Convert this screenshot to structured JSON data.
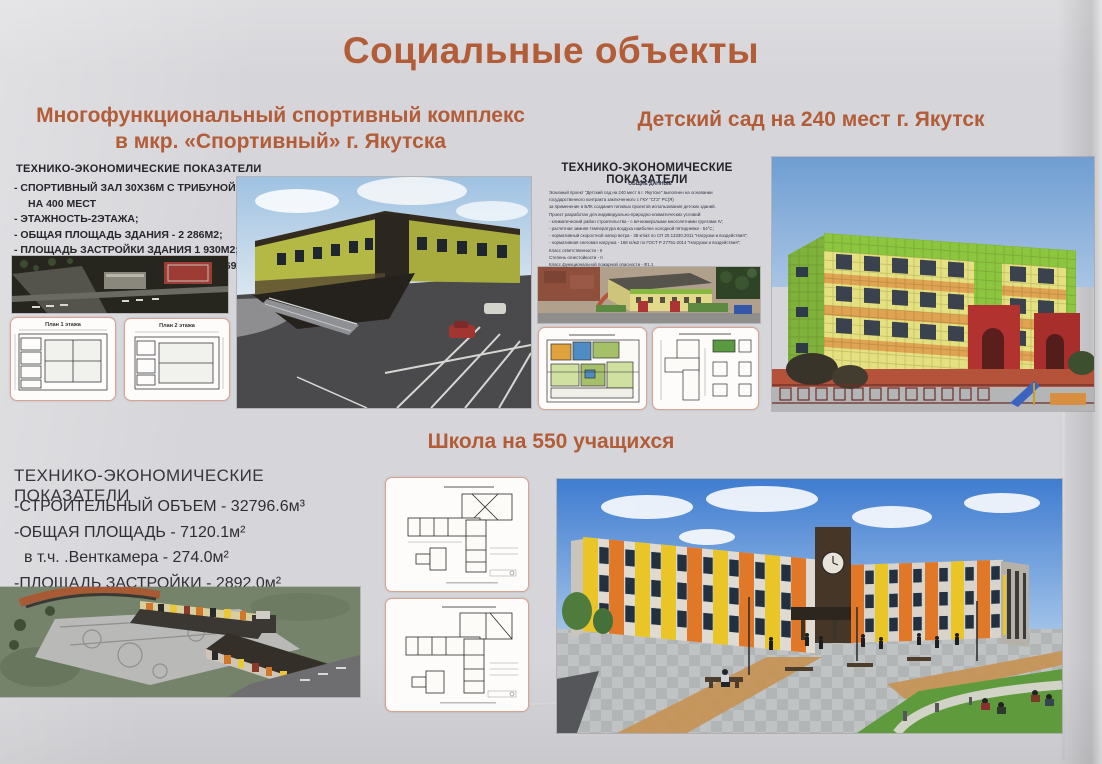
{
  "title": "Социальные объекты",
  "colors": {
    "accent": "#b25c38",
    "poster_bg": "#d6d6da",
    "body_text": "#26262b",
    "tep_text": "#35353b"
  },
  "sport": {
    "title_line1": "Многофункциональный спортивный комплекс",
    "title_line2": "в мкр. «Спортивный» г. Якутска",
    "tep_heading": "ТЕХНИКО-ЭКОНОМИЧЕСКИЕ ПОКАЗАТЕЛИ",
    "indicators": [
      "- СПОРТИВНЫЙ ЗАЛ 30Х36М С ТРИБУНОЙ",
      "НА 400 МЕСТ",
      "- ЭТАЖНОСТЬ-2ЭТАЖА;",
      "- ОБЩАЯ ПЛОЩАДЬ ЗДАНИЯ - 2 286М2;",
      "- ПЛОЩАДЬ ЗАСТРОЙКИ ЗДАНИЯ  1 930М2;",
      "- СТРОИТЕЛЬНЫЙ ОБЪЕМ ЗДАНИЯ - 16 692М3;"
    ],
    "plan1_label": "План 1 этажа",
    "plan2_label": "План 2 этажа"
  },
  "kindergarten": {
    "title": "Детский сад на 240 мест г. Якутск",
    "tep_heading": "ТЕХНИКО-ЭКОНОМИЧЕСКИЕ ПОКАЗАТЕЛИ",
    "notes_heading": "ОБЩИЕ ДАННЫЕ",
    "notes": [
      "Эскизный проект \"Детский сад на 240 мест в г. Якутске\" выполнен на основании",
      "государственного контракта заключенного с ГКУ \"СГЗ\" РС(Я)",
      "за применение в БЛК создания типовых проектов использования детских зданий.",
      "Проект разработан для индивидуально-природно-климатических условий:",
      "- климатический район строительства - с вечномерзлыми многолетними грунтами IV;",
      "- расчетная зимняя температура воздуха наиболее холодной пятидневки - 54°С;",
      "- нормативный скоростной напор ветра - 38 кг/м2 по СП 20.13330.2011 \"Нагрузки и воздействия\";",
      "- нормативная снеговая нагрузка - 168 кг/м2 по ГОСТ Р 27751-2014 \"Нагрузки и воздействия\";",
      "Класс ответственности - II",
      "Степень огнестойкости - II",
      "Класс функциональной пожарной опасности - Ф1.1",
      "Класс конструктивной пожарной опасности - С0"
    ]
  },
  "school": {
    "title": "Школа на 550 учащихся",
    "tep_heading": "ТЕХНИКО-ЭКОНОМИЧЕСКИЕ ПОКАЗАТЕЛИ",
    "indicators": [
      "-СТРОИТЕЛЬНЫЙ ОБЪЕМ - 32796.6м³",
      "-ОБЩАЯ ПЛОЩАДЬ - 7120.1м²",
      "в т.ч. .Венткамера - 274.0м²",
      "-ПЛОЩАДЬ ЗАСТРОЙКИ - 2892.0м²"
    ]
  }
}
